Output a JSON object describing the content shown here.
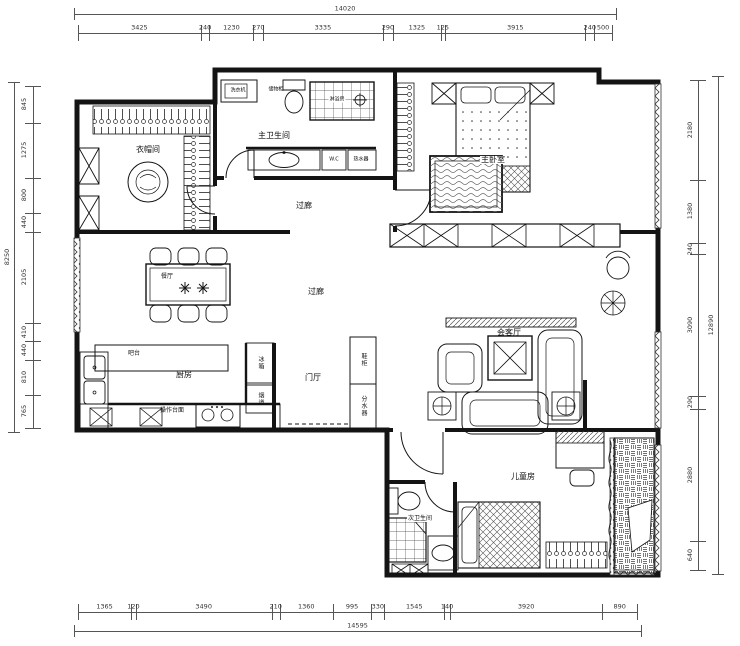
{
  "dims": {
    "top": {
      "total": "14020",
      "segments": [
        "3425",
        "240",
        "1230",
        "270",
        "3335",
        "290",
        "1325",
        "125",
        "3915",
        "240",
        "500"
      ]
    },
    "bottom": {
      "total": "14595",
      "segments": [
        "1365",
        "120",
        "3490",
        "210",
        "1360",
        "995",
        "330",
        "1545",
        "140",
        "3920",
        "890"
      ]
    },
    "left": {
      "total": "8250",
      "segments": [
        "845",
        "1275",
        "800",
        "440",
        "2105",
        "410",
        "440",
        "810",
        "765"
      ]
    },
    "right": {
      "total": "12890",
      "segments": [
        "2180",
        "1380",
        "240",
        "3090",
        "290",
        "2880",
        "640"
      ]
    }
  },
  "rooms": {
    "cloakroom": "衣帽间",
    "master_bath": "主卫生间",
    "corridor_top": "过廊",
    "master_bedroom": "主卧室",
    "corridor_main": "过廊",
    "dining": "餐厅",
    "bar": "吧台",
    "kitchen": "厨房",
    "counter": "操作台面",
    "foyer": "门厅",
    "living": "会客厅",
    "kids": "儿童房",
    "second_bath": "次卫生间"
  },
  "fixtures": {
    "washer": "洗衣机",
    "storage": "储物柜",
    "shower": "淋浴房",
    "wc": "W.C",
    "heater": "热水器",
    "fridge": "冰箱",
    "flue": "烟道",
    "shoe": "鞋柜",
    "manifold": "分水器"
  }
}
